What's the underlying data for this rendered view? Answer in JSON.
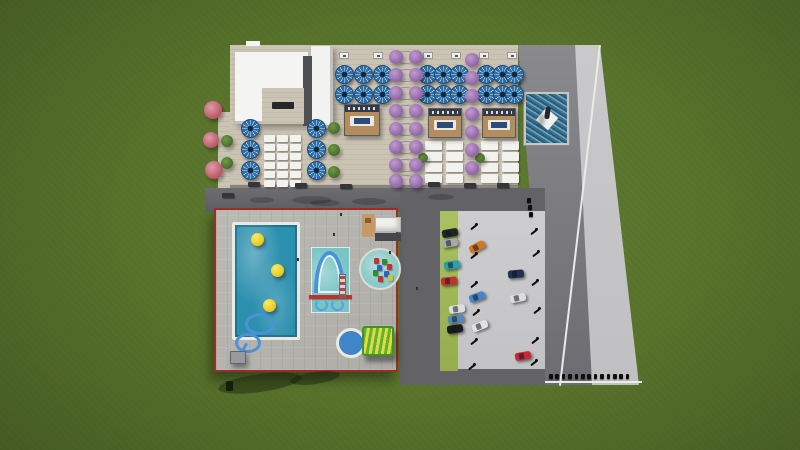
{
  "scene": {
    "title": "aquapark-resort-aerial-render",
    "description": "Aerial 3D architectural render of an aquapark resort on green grass: sunbathing deck with blue parasols, white loungers and cabanas, a white service building, a flowering pergola walkway, a fountain pool, a red-bordered pool complex with a main pool, kids pool with arch slide, splash pad and round pool with slide, plus a parking lot with cars and a perimeter road"
  },
  "palette": {
    "grass": "#59732c",
    "grass_dark": "#3d5220",
    "deck": "#cbc3b4",
    "deck_line": "#c1b9aa",
    "road_dark": "#636367",
    "road_medium": "#7b7b80",
    "sidewalk": "#c7c7c9",
    "parking_green": "#a9c161",
    "pool_water": "#2b8fae",
    "kids_water": "#79c4c4",
    "round_pool_water": "#3f86c8",
    "red_border": "#9e2b26",
    "building_white": "#f4f4f2",
    "umbrella_blue": "#2f6fa8",
    "umbrella_light": "#d9e8f2",
    "ball_yellow": "#e8c81e",
    "cabana_wood": "#b48c5e",
    "slide_blue": "#4a93d6",
    "slide_green": "#57b53a",
    "slide_yellow": "#e8d83c",
    "tree_pink": "#b4505e",
    "tree_purple": "#8a5fa0",
    "tree_green": "#41662a"
  },
  "deck": {
    "umbrellas": [
      [
        344,
        74
      ],
      [
        363,
        74
      ],
      [
        382,
        74
      ],
      [
        344,
        94
      ],
      [
        363,
        94
      ],
      [
        382,
        94
      ],
      [
        427,
        74
      ],
      [
        443,
        74
      ],
      [
        459,
        74
      ],
      [
        427,
        94
      ],
      [
        443,
        94
      ],
      [
        459,
        94
      ],
      [
        486,
        74
      ],
      [
        502,
        74
      ],
      [
        514,
        74
      ],
      [
        486,
        94
      ],
      [
        502,
        94
      ],
      [
        514,
        94
      ],
      [
        250,
        128
      ],
      [
        250,
        149
      ],
      [
        250,
        170
      ],
      [
        316,
        128
      ],
      [
        316,
        149
      ],
      [
        316,
        170
      ]
    ],
    "lounger_groups": [
      {
        "cols": [
          264,
          277,
          290
        ],
        "y": 135,
        "rows": 6,
        "dy": 9,
        "w": 11,
        "h": 7
      },
      {
        "cols": [
          425,
          446
        ],
        "y": 141,
        "rows": 4,
        "dy": 11,
        "w": 17,
        "h": 9
      },
      {
        "cols": [
          481,
          502
        ],
        "y": 141,
        "rows": 4,
        "dy": 11,
        "w": 17,
        "h": 9
      }
    ],
    "cabanas": [
      [
        344,
        104,
        36,
        32
      ],
      [
        428,
        108,
        34,
        30
      ],
      [
        482,
        108,
        34,
        30
      ]
    ],
    "signs": [
      [
        339,
        52
      ],
      [
        373,
        52
      ],
      [
        423,
        52
      ],
      [
        451,
        52
      ],
      [
        479,
        52
      ],
      [
        507,
        52
      ]
    ],
    "benches": [
      [
        248,
        182
      ],
      [
        295,
        183
      ],
      [
        340,
        184
      ],
      [
        428,
        182
      ],
      [
        464,
        183
      ],
      [
        497,
        183
      ],
      [
        222,
        193
      ]
    ]
  },
  "landscape": {
    "pink_trees": [
      [
        213,
        110,
        9
      ],
      [
        211,
        140,
        8
      ],
      [
        214,
        170,
        9
      ]
    ],
    "green_bushes": [
      [
        334,
        128,
        6
      ],
      [
        334,
        150,
        6
      ],
      [
        334,
        172,
        6
      ],
      [
        227,
        141,
        6
      ],
      [
        227,
        163,
        6
      ],
      [
        423,
        158,
        5
      ],
      [
        480,
        158,
        5
      ]
    ],
    "walkway": {
      "left_x": 396,
      "right_x": 416,
      "arch_x": 406,
      "tree_r": 7,
      "rows": [
        57,
        75,
        93,
        111,
        129,
        147,
        165,
        181
      ]
    },
    "right_tree_column": {
      "x": 472,
      "tree_r": 7,
      "rows": [
        60,
        78,
        96,
        114,
        132,
        150,
        168
      ]
    }
  },
  "pool_area": {
    "balls": [
      [
        41,
        29
      ],
      [
        61,
        60
      ],
      [
        53,
        95
      ]
    ],
    "splash_items": [
      [
        13,
        8,
        "#c8312e"
      ],
      [
        21,
        9,
        "#2f8f2c"
      ],
      [
        16,
        15,
        "#3261c2"
      ],
      [
        26,
        14,
        "#c8312e"
      ],
      [
        12,
        20,
        "#2f8f2c"
      ],
      [
        23,
        21,
        "#3261c2"
      ],
      [
        17,
        26,
        "#c8312e"
      ],
      [
        27,
        25,
        "#d8c02e"
      ]
    ]
  },
  "parking": {
    "cars": [
      {
        "x": 450,
        "y": 233,
        "c": "#232326",
        "r": -10
      },
      {
        "x": 450,
        "y": 243,
        "c": "#a8a8aa",
        "r": -10
      },
      {
        "x": 452,
        "y": 265,
        "c": "#2b9fae",
        "r": -8
      },
      {
        "x": 449,
        "y": 281,
        "c": "#c62f2f",
        "r": -6
      },
      {
        "x": 477,
        "y": 247,
        "c": "#d4761e",
        "r": -28
      },
      {
        "x": 477,
        "y": 297,
        "c": "#4584c8",
        "r": -20
      },
      {
        "x": 480,
        "y": 326,
        "c": "#e2e2e4",
        "r": -22
      },
      {
        "x": 457,
        "y": 309,
        "c": "#dededf",
        "r": -8
      },
      {
        "x": 456,
        "y": 319,
        "c": "#5588b4",
        "r": -8
      },
      {
        "x": 455,
        "y": 329,
        "c": "#1b1b1f",
        "r": -8
      },
      {
        "x": 516,
        "y": 274,
        "c": "#23304e",
        "r": -5
      },
      {
        "x": 518,
        "y": 298,
        "c": "#dcdcde",
        "r": -12
      },
      {
        "x": 523,
        "y": 356,
        "c": "#c62834",
        "r": -10
      }
    ],
    "lamps": [
      [
        470,
        226
      ],
      [
        470,
        255
      ],
      [
        470,
        284
      ],
      [
        472,
        312
      ],
      [
        470,
        341
      ],
      [
        468,
        366
      ],
      [
        530,
        231
      ],
      [
        532,
        253
      ],
      [
        531,
        282
      ],
      [
        533,
        310
      ],
      [
        531,
        340
      ],
      [
        530,
        362
      ]
    ],
    "entry_bollards": [
      [
        527,
        198
      ],
      [
        528,
        205
      ],
      [
        529,
        212
      ]
    ]
  },
  "street": {
    "bollard_row": {
      "x0": 549,
      "y": 374,
      "count": 13,
      "gap": 6.4
    }
  },
  "shadows": {
    "road": [
      [
        292,
        196,
        40,
        8
      ],
      [
        352,
        198,
        34,
        7
      ],
      [
        428,
        194,
        26,
        6
      ],
      [
        250,
        197,
        24,
        6
      ],
      [
        310,
        200,
        30,
        6
      ]
    ],
    "grass": [
      [
        218,
        374,
        84,
        18
      ],
      [
        290,
        372,
        50,
        12
      ]
    ]
  },
  "specks": [
    [
      340,
      213
    ],
    [
      297,
      258
    ],
    [
      333,
      233
    ],
    [
      389,
      251
    ],
    [
      416,
      287
    ]
  ]
}
